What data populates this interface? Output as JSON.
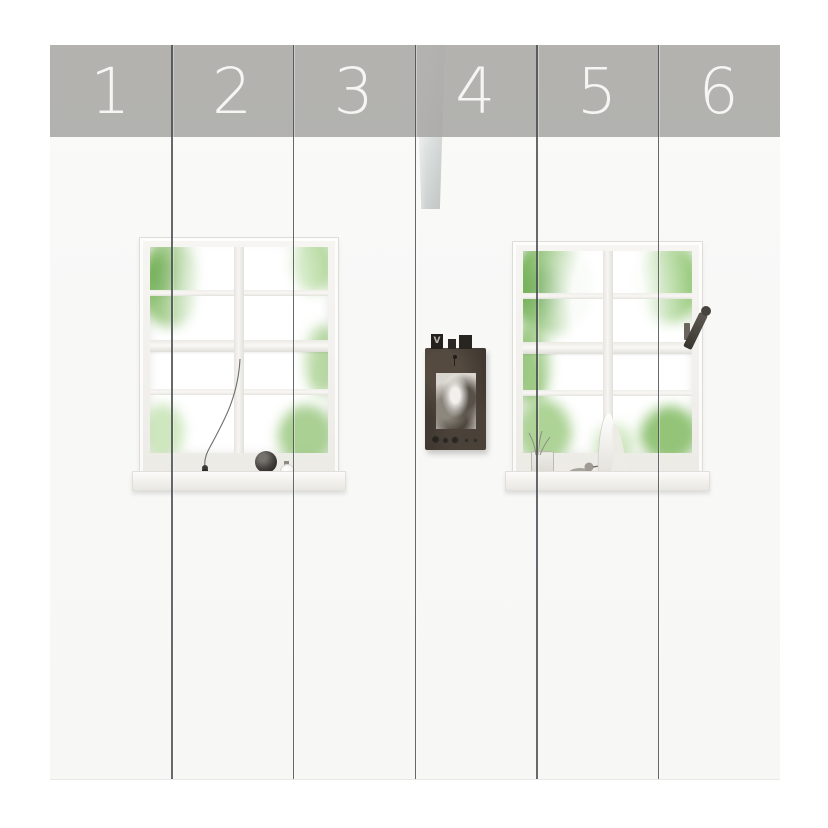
{
  "preview": {
    "type": "wallpaper-panel-preview",
    "panel_count": 6,
    "panels": [
      {
        "label": "1"
      },
      {
        "label": "2"
      },
      {
        "label": "3"
      },
      {
        "label": "4"
      },
      {
        "label": "5"
      },
      {
        "label": "6"
      }
    ],
    "colors": {
      "page_background": "#ffffff",
      "wall": "#f8f8f7",
      "band": "rgba(166,165,162,0.85)",
      "number": "#f6f5f3",
      "divider": "#474a4d",
      "beam": "#d7dad9",
      "foliage_dark": "#56a038",
      "foliage_light": "#9bcd7c",
      "frame_board": "#3b342d"
    },
    "scene": {
      "frame_tab_letter": "V"
    }
  }
}
